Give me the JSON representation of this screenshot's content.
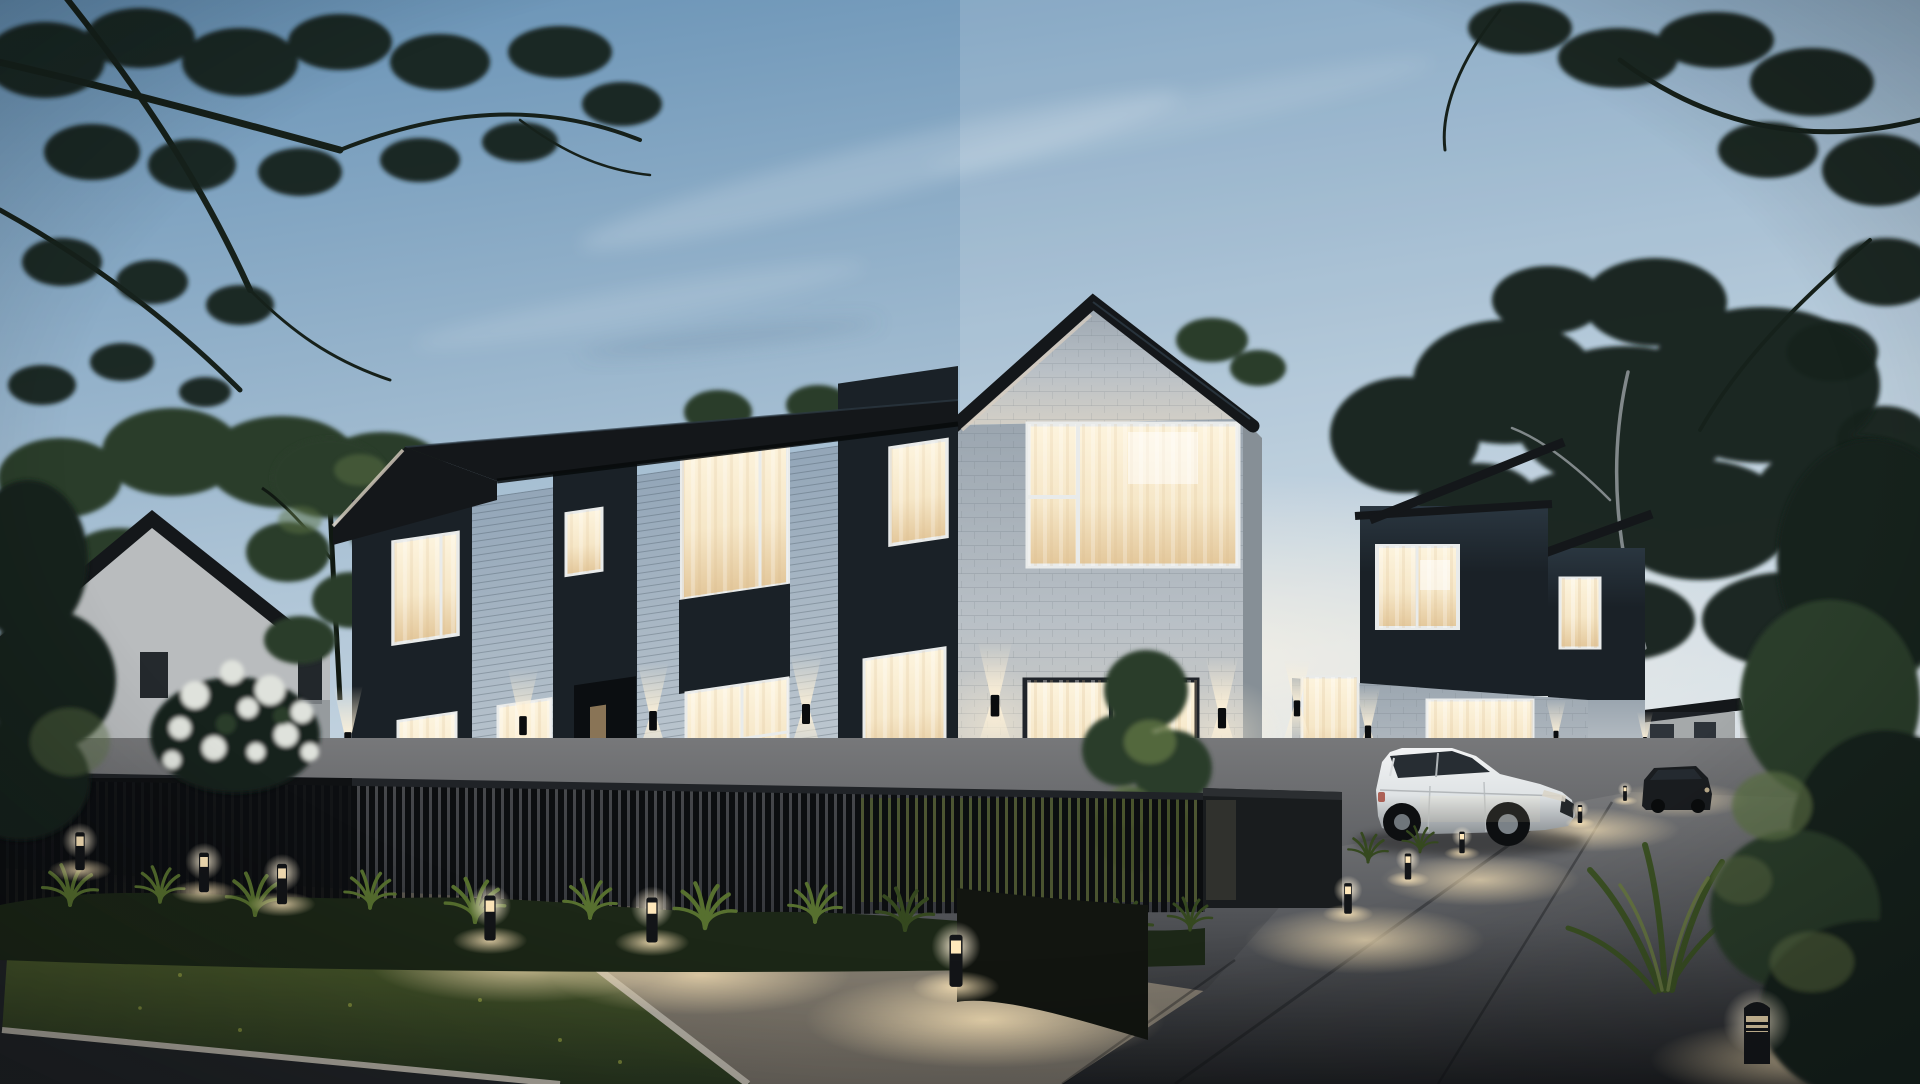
{
  "meta": {
    "kind": "architectural-exterior-rendering",
    "description": "Dusk view of a modern two-storey townhouse development: white weatherboard and white-brick facades with black cladding accents, warm lit windows, black slat fencing, landscaped path with bollard lights, driveway with parked white SUV and a dark car, framed by tree silhouettes.",
    "width_px": 1920,
    "height_px": 1084,
    "time_of_day": "dusk"
  },
  "scene": {
    "sky": {
      "label": "dusk sky with wispy clouds",
      "cloud_streaks": 3
    },
    "vegetation": {
      "overhanging_tree_silhouettes": 2,
      "background_tree_masses": 3,
      "white_blossom_bush": 1,
      "ornamental_grass_clumps": 12,
      "foreground_plant_bed_right": 1
    },
    "buildings": [
      {
        "id": "left-house",
        "style": "neighbouring gable house, pale walls, dark roof",
        "lit_windows": 0,
        "dark_windows": 3
      },
      {
        "id": "townhouse-wing",
        "style": "two-storey terrace, white weatherboard with black vertical-panel sections",
        "lit_windows": 9,
        "entry_doors": 1,
        "wall_sconces": 4
      },
      {
        "id": "corner-unit",
        "style": "white brick gable unit",
        "lit_windows": 2,
        "wall_sconces": 2
      },
      {
        "id": "unit-2",
        "style": "black-clad upper storey over white brick base",
        "lit_windows": 4,
        "wall_sconces": 2
      },
      {
        "id": "unit-3",
        "style": "black-clad upper storey over white brick base",
        "lit_windows": 2,
        "wall_sconces": 1
      },
      {
        "id": "distant-house",
        "style": "small white house at end of driveway",
        "lit_windows": 0
      }
    ],
    "vehicles": [
      {
        "id": "white-suv",
        "type": "crossover SUV",
        "color": "white",
        "location": "driveway, front"
      },
      {
        "id": "dark-car",
        "type": "hatchback",
        "color": "dark grey",
        "location": "driveway, rear"
      }
    ],
    "site": {
      "fence": "black vertical-slat fence with low dark masonry wall",
      "bollard_lights": 7,
      "driveway_path_lights": 6,
      "foreground_bollard": 1,
      "lawn_verge": "rectangular grass verge with pale concrete curbs",
      "surfaces": [
        "asphalt road",
        "concrete sidewalk",
        "concrete driveway"
      ]
    }
  },
  "palette": {
    "skyTop": "#6590b4",
    "skyMid": "#a9c1d4",
    "skyHorizon": "#e9edf0",
    "horizonGlow": "#fff6e6",
    "treeDark": "#16201a",
    "treeGreen": "#2c3d2c",
    "treeLit": "#5c7244",
    "roof": "#14171a",
    "fasciaLight": "#d8cec0",
    "cladDark": "#1a2127",
    "cladDarker": "#10151a",
    "cladSheen": "#2a3640",
    "sidingLight": "#c3ccd3",
    "sidingShade": "#93a6b8",
    "brick": "#b9c0c6",
    "brickShade": "#9aa5af",
    "brickLit": "#d3cfc6",
    "frameWhite": "#e9ebea",
    "frameDark": "#20242a",
    "windowBright": "#fdf4de",
    "windowWarm": "#f6e7c8",
    "windowDim": "#e3c79a",
    "doorDark": "#0b0e11",
    "fenceSlat": "#0c0e10",
    "fenceRail": "#202327",
    "wallDark": "#191c1e",
    "sidewalk": "#6c675f",
    "sidewalkLit": "#968d7c",
    "driveway": "#57595d",
    "driveFar": "#77787a",
    "paveNear": "#1d1f22",
    "road": "#212427",
    "curb": "#b5b0a5",
    "grass": "#27351f",
    "grassLit": "#55652e",
    "shrub": "#1c2717",
    "shrubLit": "#57702f",
    "poolWarm": "#ffe8bb",
    "sconceGlow": "#fff2d8",
    "suvWhite": "#dfe3e5",
    "suvHi": "#f2f3f4",
    "suvShadow": "#8d9296",
    "glass": "#272d33",
    "carDark": "#1a1d20",
    "distantWhite": "#c9cbc9",
    "blossom": "#dfe2dc"
  }
}
